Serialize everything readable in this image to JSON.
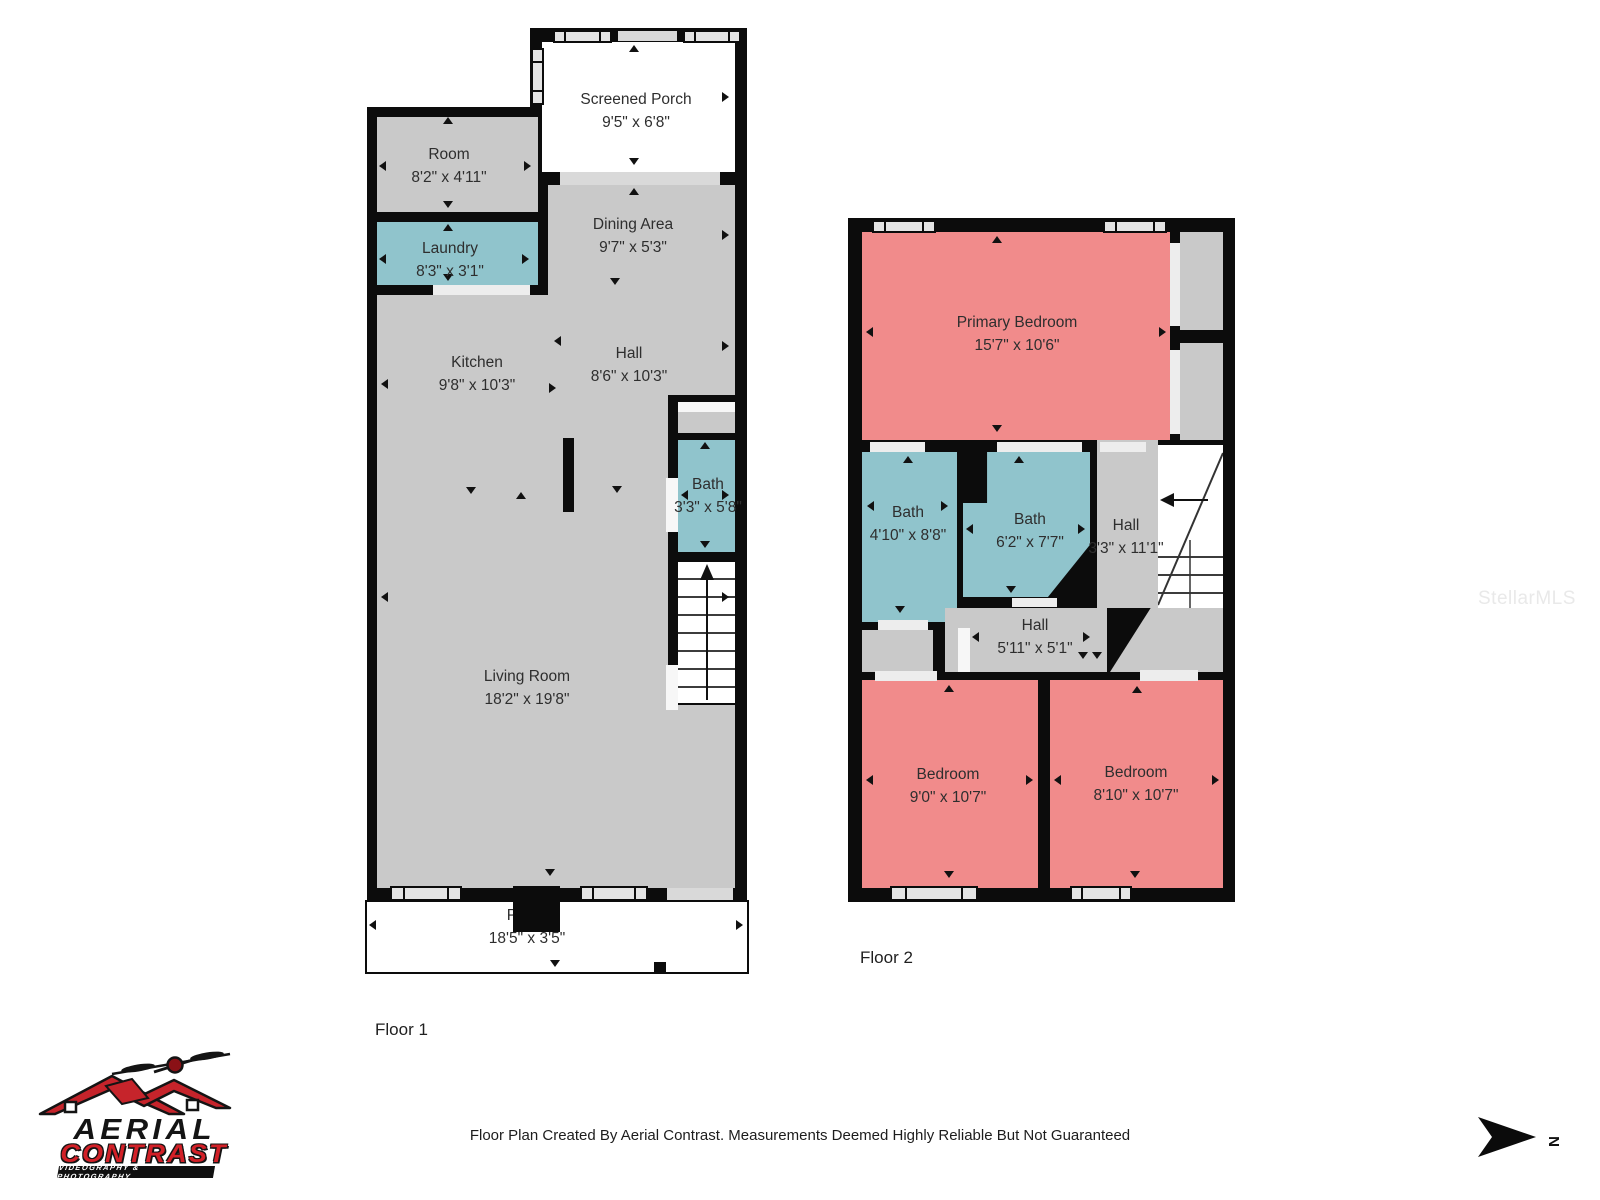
{
  "meta": {
    "footer": "Floor Plan Created By Aerial Contrast. Measurements Deemed Highly Reliable But Not Guaranteed",
    "watermark": "StellarMLS"
  },
  "branding": {
    "line1": "AERIAL",
    "line2": "CONTRAST",
    "tagline": "VIDEOGRAPHY & PHOTOGRAPHY"
  },
  "compass": {
    "label": "N"
  },
  "colors": {
    "room_gray": "#c9c9c9",
    "wet_room_teal": "#90c4cc",
    "bedroom_pink": "#f18b8b",
    "wall_black": "#0c0c0c",
    "window_gray": "#e4e4e4",
    "brand_red": "#d22027"
  },
  "floor1": {
    "label": "Floor 1",
    "rooms": {
      "screened_porch": {
        "name": "Screened Porch",
        "dims": "9'5\" x 6'8\""
      },
      "room": {
        "name": "Room",
        "dims": "8'2\" x 4'11\""
      },
      "laundry": {
        "name": "Laundry",
        "dims": "8'3\" x 3'1\""
      },
      "dining": {
        "name": "Dining Area",
        "dims": "9'7\" x 5'3\""
      },
      "kitchen": {
        "name": "Kitchen",
        "dims": "9'8\" x 10'3\""
      },
      "hall": {
        "name": "Hall",
        "dims": "8'6\" x 10'3\""
      },
      "bath": {
        "name": "Bath",
        "dims": "3'3\" x 5'8\""
      },
      "living": {
        "name": "Living Room",
        "dims": "18'2\" x 19'8\""
      },
      "porch": {
        "name": "Porch",
        "dims": "18'5\" x 3'5\""
      }
    }
  },
  "floor2": {
    "label": "Floor 2",
    "rooms": {
      "primary": {
        "name": "Primary Bedroom",
        "dims": "15'7\" x 10'6\""
      },
      "bath_left": {
        "name": "Bath",
        "dims": "4'10\" x 8'8\""
      },
      "bath_mid": {
        "name": "Bath",
        "dims": "6'2\" x 7'7\""
      },
      "hall_upper": {
        "name": "Hall",
        "dims": "3'3\" x 11'1\""
      },
      "hall_lower": {
        "name": "Hall",
        "dims": "5'11\" x 5'1\""
      },
      "bedroom_left": {
        "name": "Bedroom",
        "dims": "9'0\" x 10'7\""
      },
      "bedroom_right": {
        "name": "Bedroom",
        "dims": "8'10\" x 10'7\""
      }
    }
  }
}
